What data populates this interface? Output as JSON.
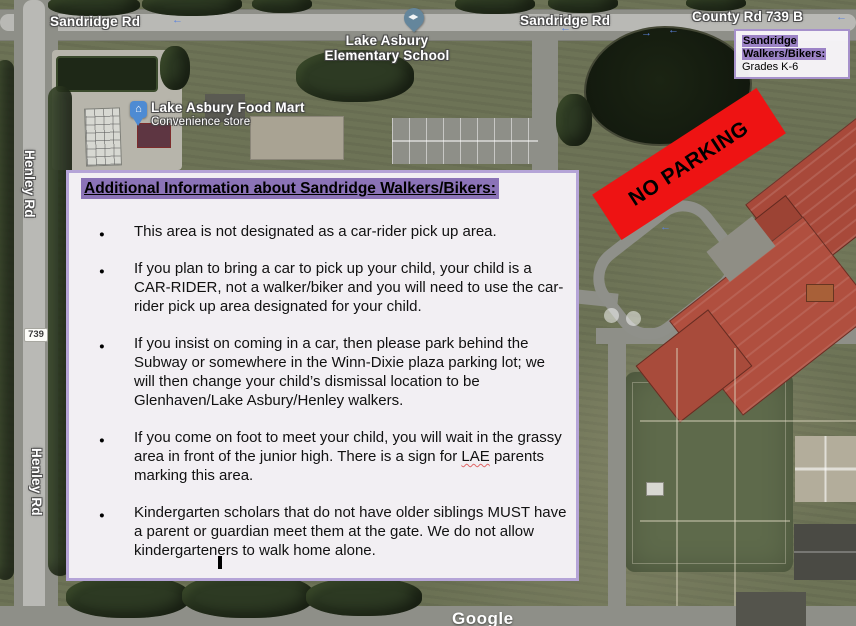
{
  "map": {
    "roads": {
      "sandridge_left": "Sandridge Rd",
      "sandridge_mid": "Sandridge Rd",
      "county": "County Rd 739 B",
      "henley_upper": "Henley Rd",
      "henley_lower": "Henley Rd",
      "route_shield": "739"
    },
    "pois": {
      "school_line1": "Lake Asbury",
      "school_line2": "Elementary School",
      "food_mart_name": "Lake Asbury Food Mart",
      "food_mart_category": "Convenience store"
    },
    "icons": {
      "arrow_left": "←",
      "arrow_right": "→",
      "store_glyph": "⌂"
    },
    "watermark": "Google"
  },
  "legend": {
    "highlight_line1": "Sandridge",
    "highlight_line2": "Walkers/Bikers:",
    "subtitle": "Grades K-6",
    "highlight_color": "#9c83c6",
    "border_color": "#a691cb"
  },
  "banner": {
    "text": "NO PARKING",
    "background_color": "#ee1313"
  },
  "info_box": {
    "heading": "Additional Information about Sandridge Walkers/Bikers:",
    "highlight_color": "#8b73b7",
    "border_color": "#b5a4d7",
    "misspelled_word": "LAE",
    "bullets": [
      "This area is not designated as a car-rider pick up area.",
      "If you plan to bring a car to pick up your child, your child is a CAR-RIDER, not a walker/biker and you will need to use the car-rider pick up area designated for your child.",
      "If you insist on coming in a car, then please park behind the Subway or somewhere in the Winn-Dixie plaza parking lot; we will then change your child’s dismissal location to be Glenhaven/Lake Asbury/Henley walkers.",
      "If you come on foot to meet your child, you will wait in the grassy area in front of the junior high. There is a sign for LAE parents marking this area.",
      "Kindergarten scholars that do not have older siblings MUST have a parent or guardian meet them at the gate. We do not allow kindergarteners to walk home alone."
    ]
  }
}
